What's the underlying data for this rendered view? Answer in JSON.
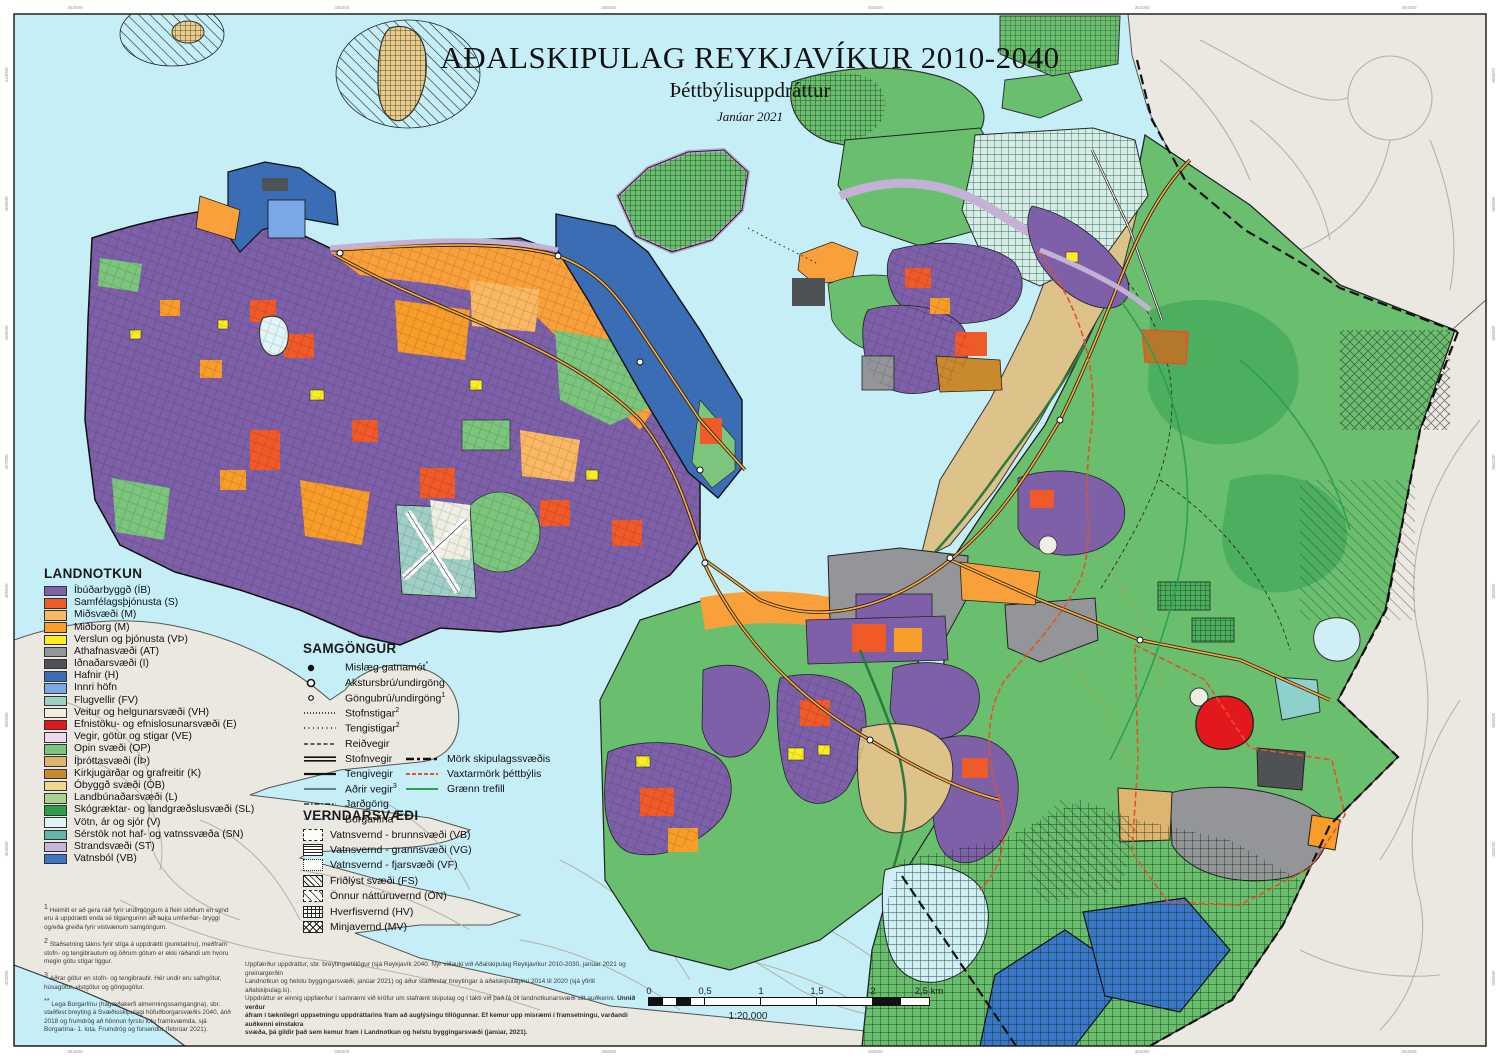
{
  "title": {
    "main": "AÐALSKIPULAG REYKJAVÍKUR 2010-2040",
    "sub": "Þéttbýlisuppdráttur",
    "date": "Janúar 2021"
  },
  "colors": {
    "sea": "#c5eef7",
    "outside_land": "#eae8e0",
    "base_green": "#6abf6e",
    "accent_boundary_red": "#e8502a",
    "plan_boundary_black": "#111111",
    "green_belt": "#2e9e4f"
  },
  "legend_landnotkun": {
    "title": "LANDNOTKUN",
    "items": [
      {
        "code": "IB",
        "label": "Íbúðarbyggð (ÍB)",
        "color": "#7d60a8"
      },
      {
        "code": "S",
        "label": "Samfélagsþjónusta (S)",
        "color": "#f05a28"
      },
      {
        "code": "M1",
        "label": "Miðsvæði (M)",
        "color": "#fbb863"
      },
      {
        "code": "M",
        "label": "Miðborg (M)",
        "color": "#f99d2a"
      },
      {
        "code": "VP",
        "label": "Verslun og þjónusta (VÞ)",
        "color": "#faee23"
      },
      {
        "code": "AT",
        "label": "Athafnasvæði (AT)",
        "color": "#939598"
      },
      {
        "code": "I",
        "label": "Iðnaðarsvæði (I)",
        "color": "#4f5254"
      },
      {
        "code": "H",
        "label": "Hafnir (H)",
        "color": "#3a6db4"
      },
      {
        "code": "IH",
        "label": "Innri höfn",
        "color": "#7aa7e8"
      },
      {
        "code": "FV",
        "label": "Flugvellir (FV)",
        "color": "#9fcfc6"
      },
      {
        "code": "VH",
        "label": "Veitur og helgunarsvæði (VH)",
        "color": "#eeeee2"
      },
      {
        "code": "E",
        "label": "Efnistöku- og efnislosunarsvæði (E)",
        "color": "#e3181d"
      },
      {
        "code": "VE",
        "label": "Vegir, götur og stigar (VE)",
        "color": "#ecd9ec"
      },
      {
        "code": "OP",
        "label": "Opin svæði (OP)",
        "color": "#7cc57d"
      },
      {
        "code": "IP",
        "label": "Íþróttasvæði  (ÍÞ)",
        "color": "#ddb56e"
      },
      {
        "code": "K",
        "label": "Kirkjugarðar og grafreitir  (K)",
        "color": "#c98a2e"
      },
      {
        "code": "OB",
        "label": "Óbyggð svæði  (ÓB)",
        "color": "#f0d88f"
      },
      {
        "code": "L",
        "label": "Landbúnaðarsvæði (L)",
        "color": "#a9d490"
      },
      {
        "code": "SL",
        "label": "Skógræktar- og landgræðslusvæði (SL)",
        "color": "#2f9e49"
      },
      {
        "code": "V",
        "label": "Vötn, ár og sjór (V)",
        "color": "#dff5f7"
      },
      {
        "code": "SN",
        "label": "Sérstök not haf- og vatnssvæða (SN)",
        "color": "#62b5a8"
      },
      {
        "code": "ST",
        "label": "Strandsvæði (ST)",
        "color": "#c6b6dd"
      },
      {
        "code": "VB",
        "label": "Vatnsból (VB)",
        "color": "#3a77c8"
      }
    ]
  },
  "legend_samgongur": {
    "title": "SAMGÖNGUR",
    "items": [
      {
        "label": "Mislæg gatnamót",
        "sup": "*",
        "glyph": "dot"
      },
      {
        "label": "Akstursbrú/undirgöng",
        "sup": "",
        "glyph": "circle"
      },
      {
        "label": "Göngubrú/undirgöng",
        "sup": "1",
        "glyph": "circle-small"
      },
      {
        "label": "Stofnstigar",
        "sup": "2",
        "glyph": "dots-dense"
      },
      {
        "label": "Tengistigar",
        "sup": "2",
        "glyph": "dots"
      },
      {
        "label": "Reiðvegir",
        "sup": "",
        "glyph": "dashed"
      },
      {
        "label": "Stofnvegir",
        "sup": "",
        "glyph": "double"
      },
      {
        "label": "Tengivegir",
        "sup": "",
        "glyph": "medium"
      },
      {
        "label": "Aðrir vegir",
        "sup": "3",
        "glyph": "thin"
      },
      {
        "label": "Jarðgöng",
        "sup": "",
        "glyph": "dashdot"
      },
      {
        "label": "Borgarlína",
        "sup": "**",
        "glyph": "dashed-blue"
      }
    ],
    "boundaries": [
      {
        "label": "Mörk skipulagssvæðis",
        "glyph": "dash-long-black"
      },
      {
        "label": "Vaxtarmörk þéttbýlis",
        "glyph": "dash-red"
      },
      {
        "label": "Grænn trefill",
        "glyph": "solid-green"
      }
    ]
  },
  "legend_verndarsvaedi": {
    "title": "VERNDARSVÆÐI",
    "items": [
      {
        "label": "Vatnsvernd - brunnsvæði (VB)",
        "pattern": "vb"
      },
      {
        "label": "Vatnsvernd - grannsvæði (VG)",
        "pattern": "vg"
      },
      {
        "label": "Vatnsvernd - fjarsvæði (VF)",
        "pattern": "vf"
      },
      {
        "label": "Friðlýst svæði (FS)",
        "pattern": "fs"
      },
      {
        "label": "Önnur náttúruvernd (ÖN)",
        "pattern": "on"
      },
      {
        "label": "Hverfisvernd (HV)",
        "pattern": "hv"
      },
      {
        "label": "Minjavernd (MV)",
        "pattern": "mv"
      }
    ]
  },
  "footnotes": [
    {
      "sup": "1",
      "text": "Heimilt er að gera ráð fyrir undirgöngum á fleiri stöðum en sýnd eru á uppdrætti enda sé tilgangurinn að auka umferðar- öryggi og/eða greiða fyrir vistvænum samgöngum."
    },
    {
      "sup": "2",
      "text": "Staðsetning tákns fyrir stíga á uppdrætti (punktalínu), meðfram stofn- og tengibrautum og öðrum götum er ekki ráðandi um hvoru megin götu stígar liggur."
    },
    {
      "sup": "3",
      "text": "Aðrar götur en stofn- og tengibrautir. Hér undir eru safngötur, húsagötur, vistgötur og göngugötur."
    },
    {
      "sup": "**",
      "text": "Lega Borgarlínu (hágæðakerfi almenningssamgangna), sbr. staðfest breyting á Svæðisskipulagi höfuðborgarsvæðis 2040, árið 2018 og frumdrög að hönnun fyrstu lotu framkvæmda, sjá Borgarlína- 1. lota. Frumdrög og forsendur (febrúar 2021)."
    }
  ],
  "disclaimer": {
    "lines": [
      [
        {
          "t": "Uppfærður uppdráttur, sbr. breytingartillögur (sjá Reykjavík 2040. Nýr viðauki við Aðalskipulag Reykjavíkur 2010-2030, janúar 2021 og greinargerðin",
          "b": false
        }
      ],
      [
        {
          "t": "Landnotkun og helstu byggingarsvæði, janúar 2021) og áður staðfestar breytingar á aðalskipulaginu 2014 til 2020 (sjá yfirlit aðalskipulag.is).",
          "b": false
        }
      ],
      [
        {
          "t": "Uppdráttur er einnig uppfærður í samræmi við kröfur um stafrænt skipulag og í takti við það fá öll landnotkunarsvæði sitt auðkenni. ",
          "b": false
        },
        {
          "t": "Unnið verður",
          "b": true
        }
      ],
      [
        {
          "t": "áfram í tæknilegri uppsetningu uppdráttarins fram að auglýsingu tillögunnar. Ef kemur upp misræmi í framsetningu, varðandi auðkenni einstakra",
          "b": true
        }
      ],
      [
        {
          "t": "svæða, þá gildir það sem kemur fram í Landnotkun og helstu byggingarsvæði (janúar, 2021).",
          "b": true
        }
      ]
    ]
  },
  "scalebar": {
    "labels": [
      "0",
      "0,5",
      "1",
      "1,5",
      "2",
      "2,5 km"
    ],
    "ratio": "1:20.000",
    "cells": [
      {
        "w": 14,
        "f": "b"
      },
      {
        "w": 14,
        "f": "w"
      },
      {
        "w": 14,
        "f": "b"
      },
      {
        "w": 14,
        "f": "w"
      },
      {
        "w": 56,
        "f": "w"
      },
      {
        "w": 56,
        "f": "w"
      },
      {
        "w": 56,
        "f": "w"
      },
      {
        "w": 28,
        "f": "b"
      },
      {
        "w": 28,
        "f": "w"
      }
    ]
  },
  "grid_labels": {
    "top": [
      "354000",
      "356000",
      "358000",
      "360000",
      "362000",
      "364000"
    ],
    "bottom": [
      "354000",
      "356000",
      "358000",
      "360000",
      "362000",
      "364000"
    ],
    "left": [
      "410000",
      "409000",
      "408000",
      "407000",
      "406000",
      "405000",
      "404000",
      "403000"
    ],
    "right": [
      "410000",
      "409000",
      "408000",
      "407000",
      "406000",
      "405000",
      "404000",
      "403000"
    ]
  }
}
